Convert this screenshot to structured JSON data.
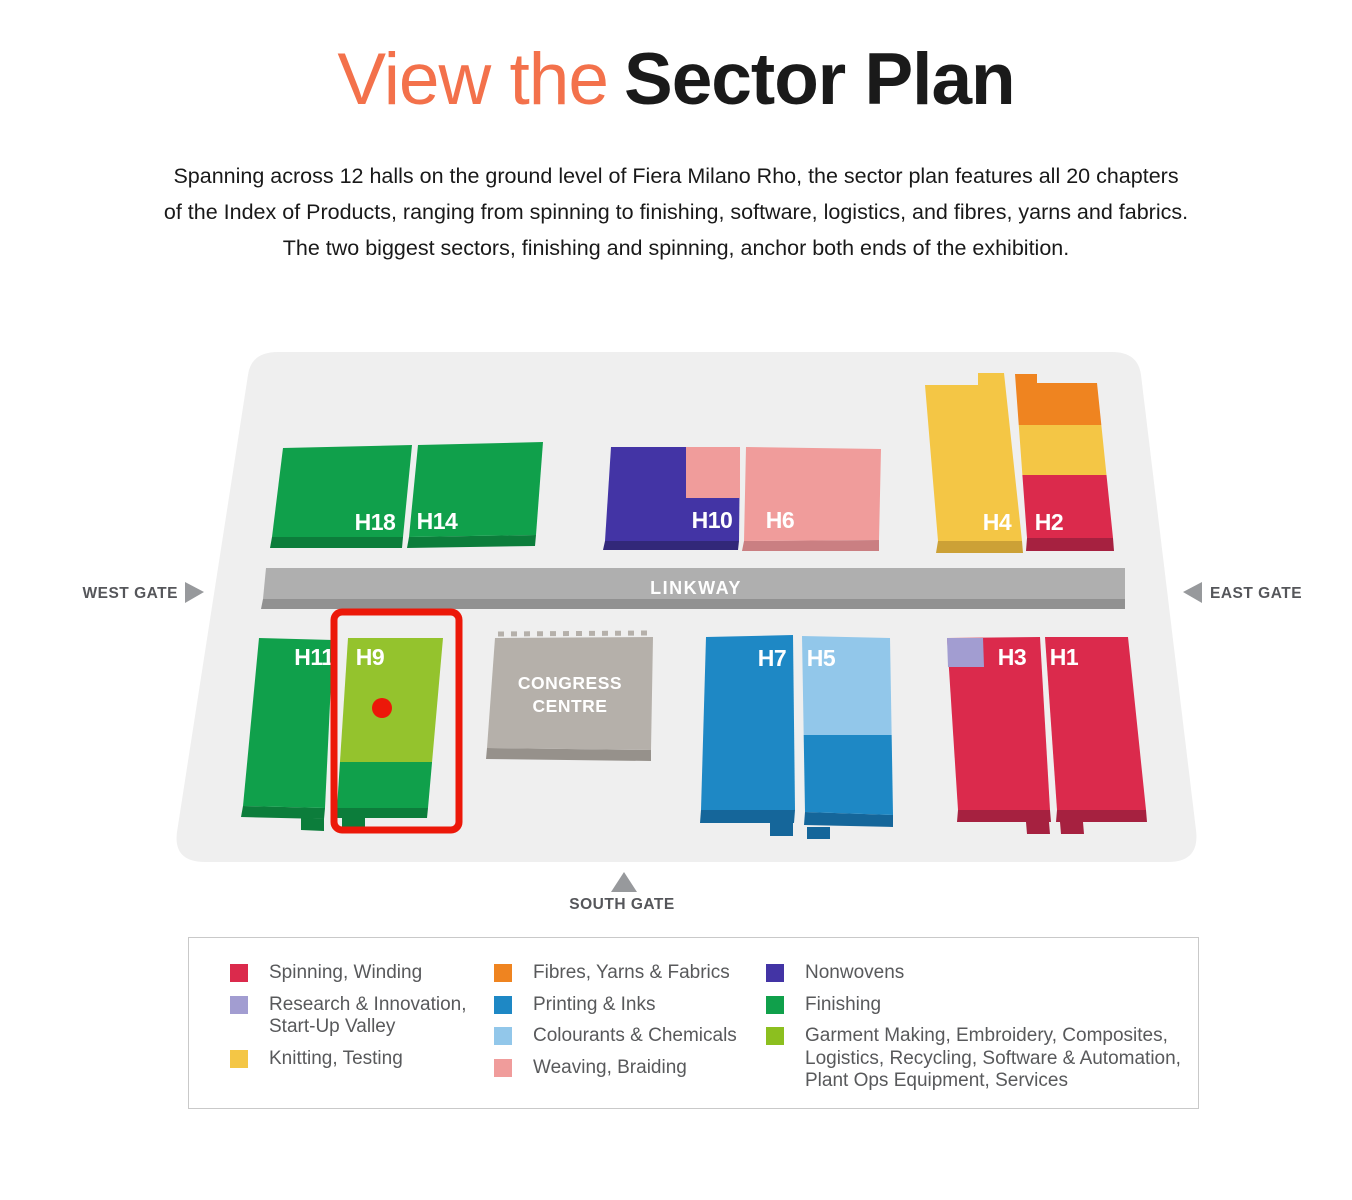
{
  "title": {
    "accent_text": "View the",
    "main_text": "Sector Plan",
    "accent_color": "#F3714B",
    "main_color": "#1A1A1A"
  },
  "intro": {
    "lines": [
      "Spanning across 12 halls on the ground level of Fiera Milano Rho, the sector plan features all 20 chapters",
      "of the Index of Products, ranging from spinning to finishing, software, logistics, and fibres, yarns and fabrics.",
      "The two biggest sectors, finishing and spinning, anchor both ends of the exhibition."
    ]
  },
  "map": {
    "gates": {
      "west": "WEST GATE",
      "east": "EAST GATE",
      "south": "SOUTH GATE"
    },
    "linkway_label": "LINKWAY",
    "congress_centre": {
      "line1": "CONGRESS",
      "line2": "CENTRE"
    },
    "halls": {
      "h18": "H18",
      "h14": "H14",
      "h10": "H10",
      "h6": "H6",
      "h4": "H4",
      "h2": "H2",
      "h11": "H11",
      "h9": "H9",
      "h7": "H7",
      "h5": "H5",
      "h3": "H3",
      "h1": "H1"
    },
    "highlight": {
      "target_hall": "H9"
    }
  },
  "colors": {
    "map_bg": "#EFEFEF",
    "green": "#10A04B",
    "green_dark": "#0C7D3B",
    "lime": "#94C32D",
    "indigo": "#4334A5",
    "indigo_dark": "#322879",
    "pink": "#F09C9B",
    "pink_dark": "#CA7F82",
    "yellow": "#F4C645",
    "yellow_dark": "#CCA136",
    "orange": "#EF8420",
    "red": "#DB2A4C",
    "red_dark": "#A62140",
    "blue": "#1E88C5",
    "blue_dark": "#15669A",
    "light_blue": "#92C7EA",
    "purple": "#A29DD1",
    "linkway": "#AFAFAF",
    "linkway_dark": "#919191",
    "congress": "#B5B0AA",
    "congress_dark": "#96918B",
    "gate_arrow": "#97999C",
    "highlight_red": "#EC1809"
  },
  "legend": {
    "columns": [
      {
        "items": [
          {
            "color": "#DB2A4C",
            "lines": [
              "Spinning, Winding"
            ]
          },
          {
            "color": "#A29DD1",
            "lines": [
              "Research & Innovation,",
              "Start-Up Valley"
            ]
          },
          {
            "color": "#F4C645",
            "lines": [
              "Knitting, Testing"
            ]
          }
        ]
      },
      {
        "items": [
          {
            "color": "#EF8420",
            "lines": [
              "Fibres, Yarns & Fabrics"
            ]
          },
          {
            "color": "#1E88C5",
            "lines": [
              "Printing & Inks"
            ]
          },
          {
            "color": "#92C7EA",
            "lines": [
              "Colourants & Chemicals"
            ]
          },
          {
            "color": "#F09C9B",
            "lines": [
              "Weaving, Braiding"
            ]
          }
        ]
      },
      {
        "items": [
          {
            "color": "#4334A5",
            "lines": [
              "Nonwovens"
            ]
          },
          {
            "color": "#10A04B",
            "lines": [
              "Finishing"
            ]
          },
          {
            "color": "#8CBF1F",
            "lines": [
              "Garment Making, Embroidery, Composites,",
              "Logistics, Recycling, Software & Automation,",
              "Plant Ops Equipment, Services"
            ]
          }
        ]
      }
    ]
  }
}
